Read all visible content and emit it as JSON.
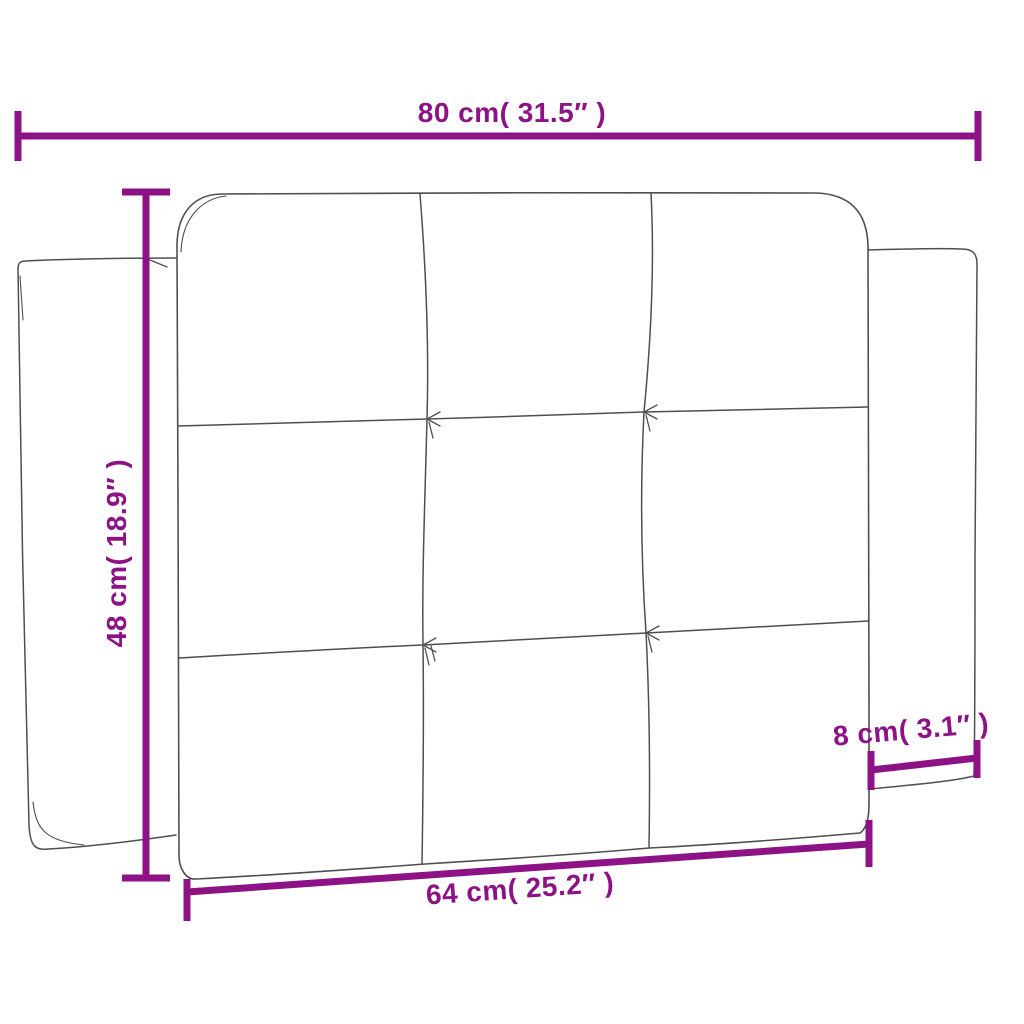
{
  "diagram": {
    "subject": "tufted headboard cushion dimension drawing",
    "colors": {
      "dimension_accent": "#8C1286",
      "outline": "#4f4f4f",
      "background": "#ffffff"
    },
    "dimensions": {
      "top_width": "80 cm( 31.5″ )",
      "side_height": "48 cm( 18.9″ )",
      "bottom_width": "64 cm( 25.2″ )",
      "side_depth": "8 cm( 3.1″ )"
    }
  }
}
